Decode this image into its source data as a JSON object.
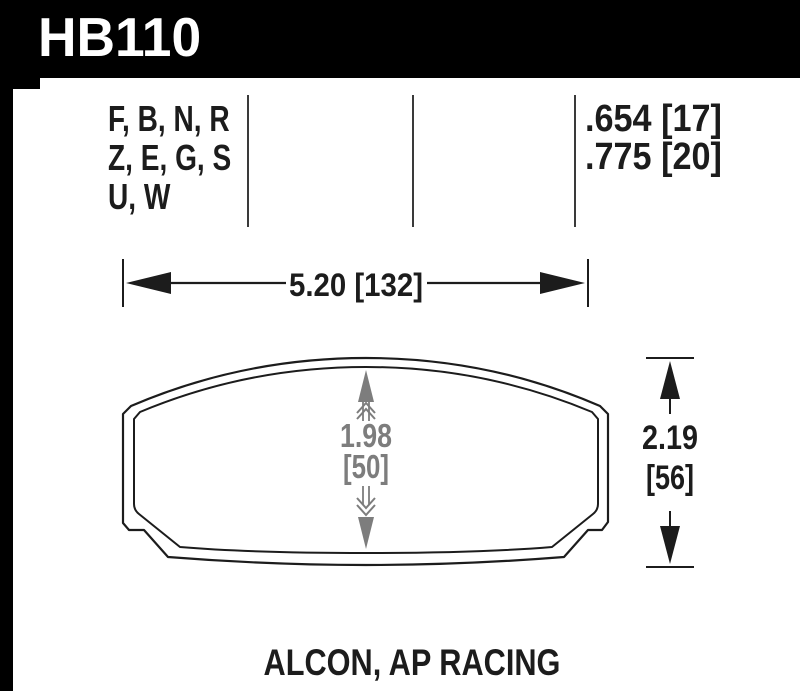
{
  "header": {
    "part_number": "HB110"
  },
  "compound_codes": {
    "lines": [
      "F, B, N, R",
      "Z, E, G, S",
      "U, W"
    ]
  },
  "pad_thickness": {
    "line1": ".654 [17]",
    "line2": ".775 [20]"
  },
  "dimensions": {
    "width": "5.20 [132]",
    "height_in": "2.19",
    "height_mm": "[56]",
    "center_in": "1.98",
    "center_mm": "[50]"
  },
  "applications": "ALCON, AP RACING",
  "colors": {
    "header_bg": "#000000",
    "header_text": "#ffffff",
    "outline": "#1c1c1c",
    "dim_gray": "#7d7d7d",
    "divider": "#3a3a3a"
  }
}
